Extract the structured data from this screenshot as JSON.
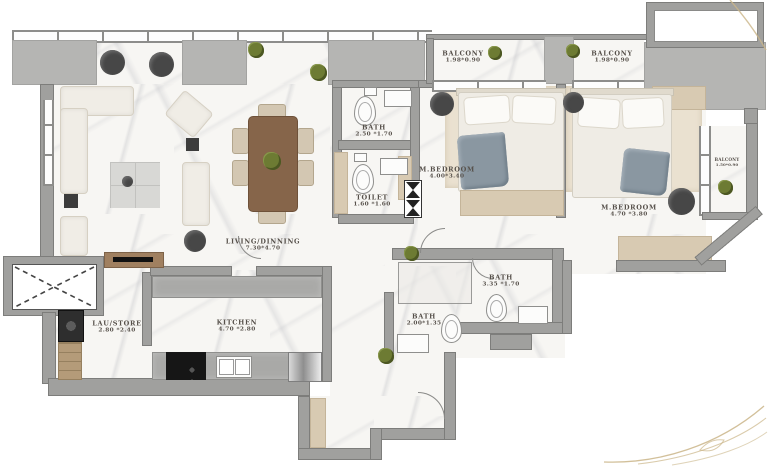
{
  "document_type": "apartment-floor-plan",
  "rooms": {
    "living": {
      "name": "LIVING/DINNING",
      "dims": "7.30*4.70"
    },
    "kitchen": {
      "name": "KITCHEN",
      "dims": "4.70 *2.80"
    },
    "lau": {
      "name": "LAU/STORE",
      "dims": "2.80 *2.40"
    },
    "bath_top": {
      "name": "BATH",
      "dims": "2.50 *1.70"
    },
    "toilet": {
      "name": "TOILET",
      "dims": "1.60 *1.60"
    },
    "bedroom1": {
      "name": "M.BEDROOM",
      "dims": "4.00*3.40"
    },
    "bedroom2": {
      "name": "M.BEDROOM",
      "dims": "4.70 *3.80"
    },
    "bath_mid": {
      "name": "BATH",
      "dims": "3.35 *1.70"
    },
    "bath_low": {
      "name": "BATH",
      "dims": "2.00*1.35"
    },
    "balcony1": {
      "name": "BALCONY",
      "dims": "1.98*0.90"
    },
    "balcony2": {
      "name": "BALCONY",
      "dims": "1.98*0.90"
    },
    "balcony3": {
      "name": "BALCONY",
      "dims": "1.50*0.90"
    }
  },
  "colors": {
    "wall": "#a0a09e",
    "terrace_block": "#b5b5b3",
    "floor_marble": "#f7f6f3",
    "bedroom_carpet": "#eae1d0",
    "wood": "#86654a",
    "textile_gray": "#8a97a1",
    "label_text": "#56504a",
    "gold_decor": "#c9b48c"
  }
}
